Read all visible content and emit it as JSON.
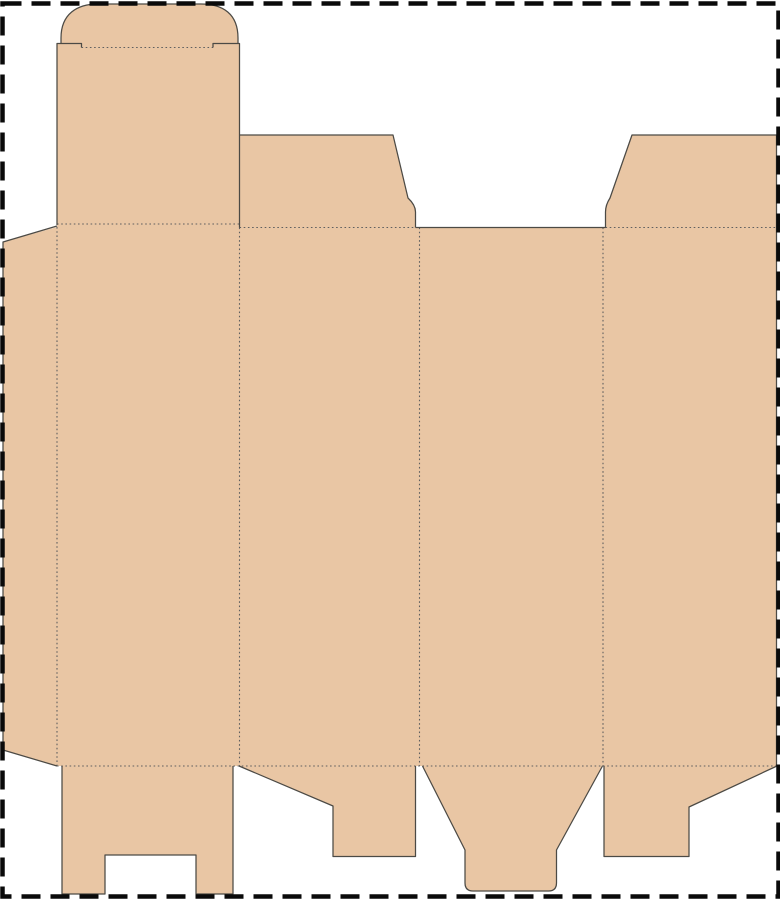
{
  "meta": {
    "description": "Folding carton dieline template with tuck top, dust flaps, glue flap and snap-lock bottom flaps",
    "visible_text": []
  },
  "canvas": {
    "width": 780,
    "height": 900,
    "background": "#ffffff"
  },
  "colors": {
    "board_fill": "#e9c6a4",
    "cut_line": "#4c4a45",
    "fold_line": "#5f5f5f",
    "trim_border": "#0a0a0a"
  },
  "styles": {
    "cut_width": 1.25,
    "fold_width": 1.1,
    "fold_dash": "1.6 2.6",
    "border_width": 4.5,
    "border_dash": "19 10"
  },
  "dieline": {
    "fills": [
      {
        "name": "glue-flap-fill",
        "d": "M 57,227 L 3,242 L 3,750 L 57,766 Z"
      },
      {
        "name": "main-body-fill",
        "d": "M 57,224 L 239.5,224 L 239.5,227.5 L 776.5,227.5 L 776.5,766 L 57,766 Z"
      },
      {
        "name": "tuck-panel-fill",
        "d": "M 57,43.5 L 239.5,43.5 L 239.5,225 L 57,225 Z"
      },
      {
        "name": "tuck-flap-fill",
        "d": "M 61,44 L 61,38 C 61,14 77,4 98,4 L 201,4 C 223,4 238,14 238,38 L 238,44 Z"
      },
      {
        "name": "top-dust-flap-left-fill",
        "d": "M 239.5,135 L 393,135 L 408,198 Q 415.5,205 415.5,212 L 415.5,228 L 239.5,228 Z"
      },
      {
        "name": "top-dust-flap-right-fill",
        "d": "M 776.5,135 L 632,135 L 610,198 Q 605.5,205 605.5,212 L 605.5,228 L 776.5,228 Z"
      },
      {
        "name": "bottom-flap-slotted-fill",
        "d": "M 62,766 L 62,894 L 105,894 L 105,855 L 196,855 L 196,894 L 233,894 L 233,766 Z"
      },
      {
        "name": "bottom-flap-left-lock-fill",
        "d": "M 239,766 L 333,806 L 333,856.5 L 415.5,856.5 L 415.5,766 Z"
      },
      {
        "name": "bottom-flap-tongue-fill",
        "d": "M 422.5,766 L 602.5,766 L 556.5,850 L 556.5,883 Q 556.5,891 548.5,891 L 473,891 Q 465,891 465,883 L 465,850 Z"
      },
      {
        "name": "bottom-flap-right-lock-fill",
        "d": "M 777,766 L 689,807 L 689,856.5 L 604,856.5 L 604,766 Z"
      }
    ],
    "cut_lines": [
      {
        "name": "glue-flap-cut",
        "d": "M 57,226 L 3,242 L 3,750 L 57,766"
      },
      {
        "name": "tuck-panel-left-shoulder-cut",
        "d": "M 57,225 L 57,43.5 L 81.5,43.5 L 81.5,47.5"
      },
      {
        "name": "tuck-flap-cut",
        "d": "M 61,44 L 61,38 C 61,14 77,4 98,4 L 201,4 C 223,4 238,14 238,38 L 238,44"
      },
      {
        "name": "tuck-panel-right-shoulder-cut",
        "d": "M 213,47.5 L 213,43.5 L 239.5,43.5 L 239.5,227.5"
      },
      {
        "name": "top-dust-flap-left-cut",
        "d": "M 239.5,135 L 393,135 L 408,198 Q 415.5,205 415.5,212 L 415.5,227.5"
      },
      {
        "name": "top-gap-cut",
        "d": "M 415.5,227.5 L 605.5,227.5"
      },
      {
        "name": "top-dust-flap-right-cut",
        "d": "M 605.5,227.5 L 605.5,212 Q 605.5,205 610,198 L 632,135 L 776.5,135"
      },
      {
        "name": "right-edge-cut",
        "d": "M 776.5,135 L 776.5,766"
      },
      {
        "name": "bottom-flap-slotted-cut",
        "d": "M 62,766 L 62,894 L 105,894 L 105,855 L 196,855 L 196,894 L 233,894 L 233,766"
      },
      {
        "name": "bottom-flap-left-lock-cut",
        "d": "M 239,766 L 333,806 L 333,856.5 L 415.5,856.5 L 415.5,766"
      },
      {
        "name": "bottom-flap-tongue-cut",
        "d": "M 422.5,766 L 465,850 L 465,883 Q 465,891 473,891 L 548.5,891 Q 556.5,891 556.5,883 L 556.5,850 L 602.5,766"
      },
      {
        "name": "bottom-flap-right-lock-cut",
        "d": "M 604,766 L 604,856.5 L 689,856.5 L 689,807 L 777,766"
      }
    ],
    "fold_lines": [
      {
        "name": "tuck-flap-fold",
        "d": "M 81.5,47.5 L 213,47.5"
      },
      {
        "name": "top-fold-first-panel",
        "d": "M 57,224 L 239.5,224"
      },
      {
        "name": "top-fold-second-panel",
        "d": "M 239.5,227.5 L 415.5,227.5"
      },
      {
        "name": "top-fold-fourth-panel",
        "d": "M 605.5,227.5 L 776.5,227.5"
      },
      {
        "name": "glue-flap-fold",
        "d": "M 57,227 L 57,766"
      },
      {
        "name": "panel-fold-1",
        "d": "M 239.5,227.5 L 239.5,766"
      },
      {
        "name": "panel-fold-2",
        "d": "M 419.5,227.5 L 419.5,766"
      },
      {
        "name": "panel-fold-3",
        "d": "M 603,227.5 L 603,766"
      },
      {
        "name": "bottom-fold",
        "d": "M 57,766 L 777,766"
      }
    ],
    "trim_border": {
      "name": "trim-border",
      "d": "M 2.5,3.5 L 778.5,3.5 L 778.5,896.5 L 2.5,896.5 Z"
    }
  }
}
